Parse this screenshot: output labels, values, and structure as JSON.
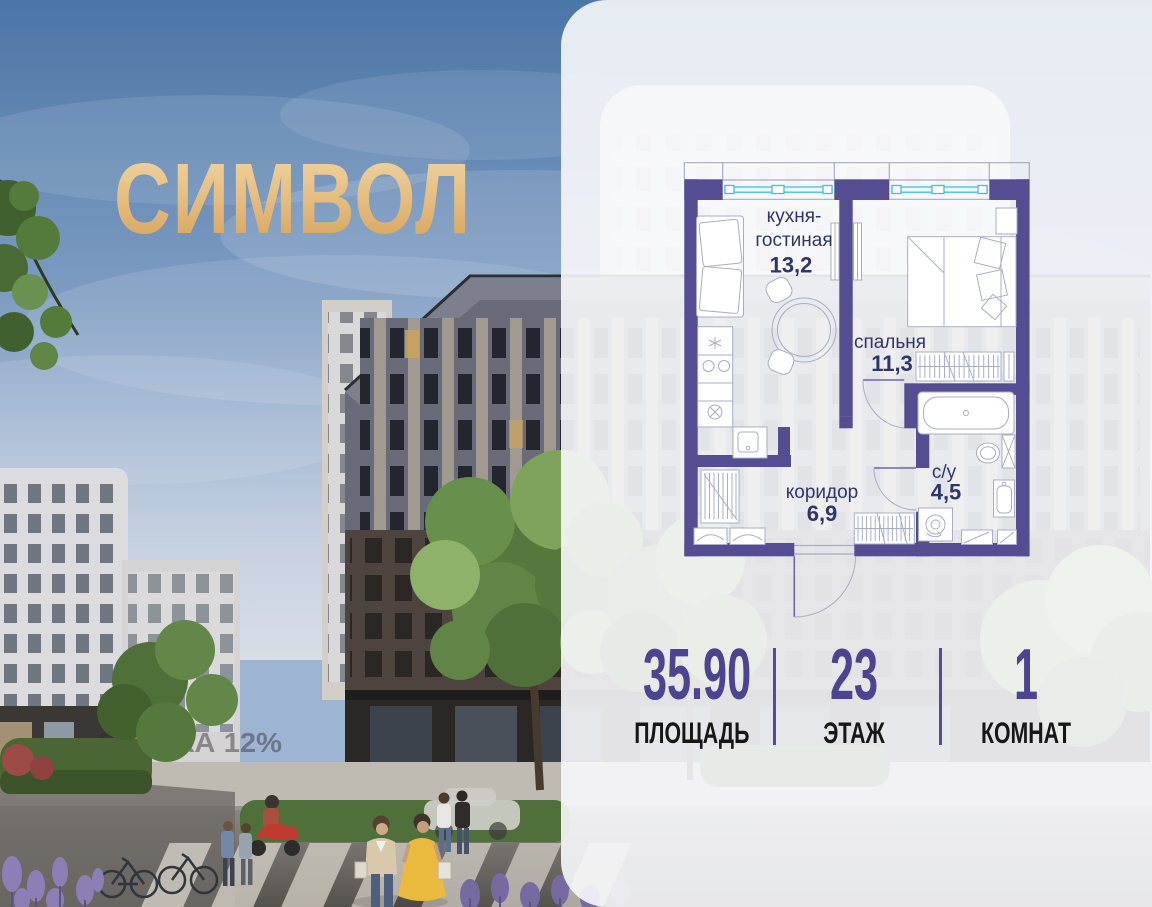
{
  "logo": {
    "text": "СИМВОЛ"
  },
  "photo": {
    "promo_watermark": "СКИДКА 12%"
  },
  "floorplan": {
    "rooms": [
      {
        "name": "kitchen-living-room",
        "label_line1": "кухня-",
        "label_line2": "гостиная",
        "area": "13,2"
      },
      {
        "name": "bedroom",
        "label": "спальня",
        "area": "11,3"
      },
      {
        "name": "corridor",
        "label": "коридор",
        "area": "6,9"
      },
      {
        "name": "bathroom",
        "label": "с/у",
        "area": "4,5"
      }
    ]
  },
  "stats": {
    "items": [
      {
        "value": "35.90",
        "label": "ПЛОЩАДЬ"
      },
      {
        "value": "23",
        "label": "ЭТАЖ"
      },
      {
        "value": "1",
        "label": "КОМНАТ"
      }
    ]
  },
  "colors": {
    "wall_purple": "#544d92",
    "accent_purple": "#4c4391",
    "logo_gold": "#e3b678",
    "plan_label_navy": "#2f356b",
    "window_glazing_cyan": "#45bcd9"
  }
}
